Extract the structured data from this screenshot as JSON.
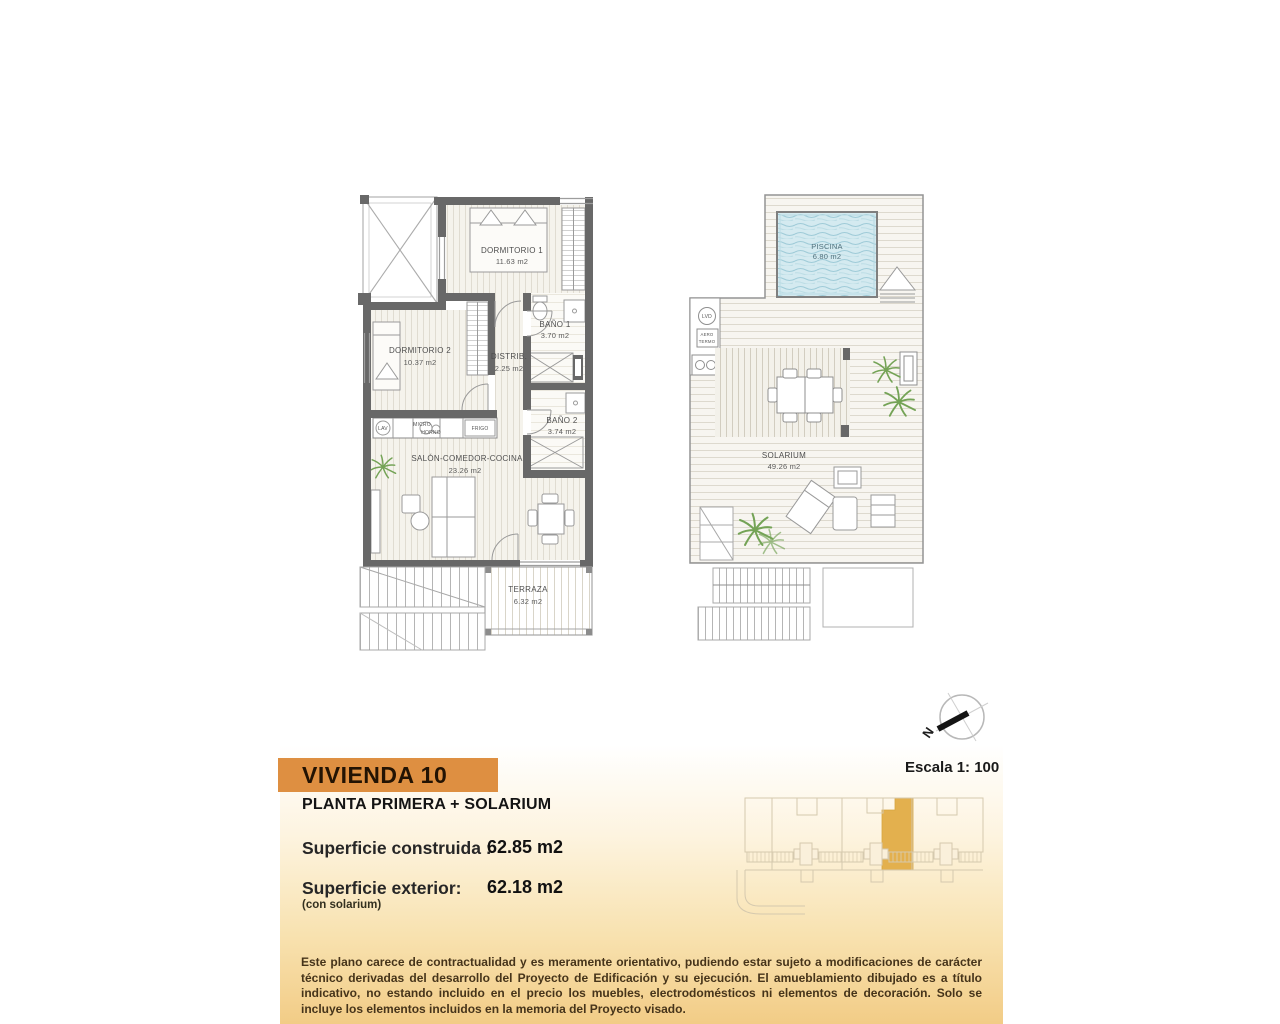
{
  "meta": {
    "scale_label": "Escala 1: 100",
    "north_label": "N"
  },
  "plan_left": {
    "rooms": {
      "dorm1": {
        "name": "DORMITORIO 1",
        "area": "11.63 m2"
      },
      "dorm2": {
        "name": "DORMITORIO 2",
        "area": "10.37 m2"
      },
      "bath1": {
        "name": "BAÑO 1",
        "area": "3.70 m2"
      },
      "distrib": {
        "name": "DISTRIB.",
        "area": "2.25 m2"
      },
      "bath2": {
        "name": "BAÑO 2",
        "area": "3.74 m2"
      },
      "salon": {
        "name": "SALÓN-COMEDOR-COCINA",
        "area": "23.26 m2"
      },
      "terraza": {
        "name": "TERRAZA",
        "area": "6.32 m2"
      }
    },
    "appliances": {
      "lav": "LAV",
      "micro": "MICRO",
      "horno": "HORNO",
      "frigo": "FRIGO"
    }
  },
  "plan_right": {
    "rooms": {
      "piscina": {
        "name": "PISCINA",
        "area": "6.80 m2"
      },
      "solarium": {
        "name": "SOLARIUM",
        "area": "49.26 m2"
      }
    },
    "fixtures": {
      "lvd": "LVD",
      "aero1": "AERO",
      "aero2": "TERMO"
    }
  },
  "info": {
    "unit_title": "VIVIENDA 10",
    "floor_subtitle": "PLANTA PRIMERA + SOLARIUM",
    "built_label": "Superficie construida :",
    "built_value": "62.85 m2",
    "exterior_label": "Superficie exterior:",
    "exterior_sub": "(con solarium)",
    "exterior_value": "62.18 m2",
    "disclaimer": "Este plano carece de contractualidad y es meramente orientativo, pudiendo estar sujeto a modificaciones de carácter técnico derivadas del desarrollo del Proyecto de Edificación y su ejecución. El amueblamiento dibujado es a título indicativo, no estando incluido en el precio los muebles, electrodomésticos ni elementos de decoración. Solo se incluye los elementos incluidos en la memoria del Proyecto visado."
  },
  "colors": {
    "accent_orange": "#DE8F41",
    "highlight_unit": "#E3B04E",
    "pool_water": "#CDE7EE",
    "panel_gradient_bottom": "#F2CC86",
    "wall_gray": "#686868"
  }
}
